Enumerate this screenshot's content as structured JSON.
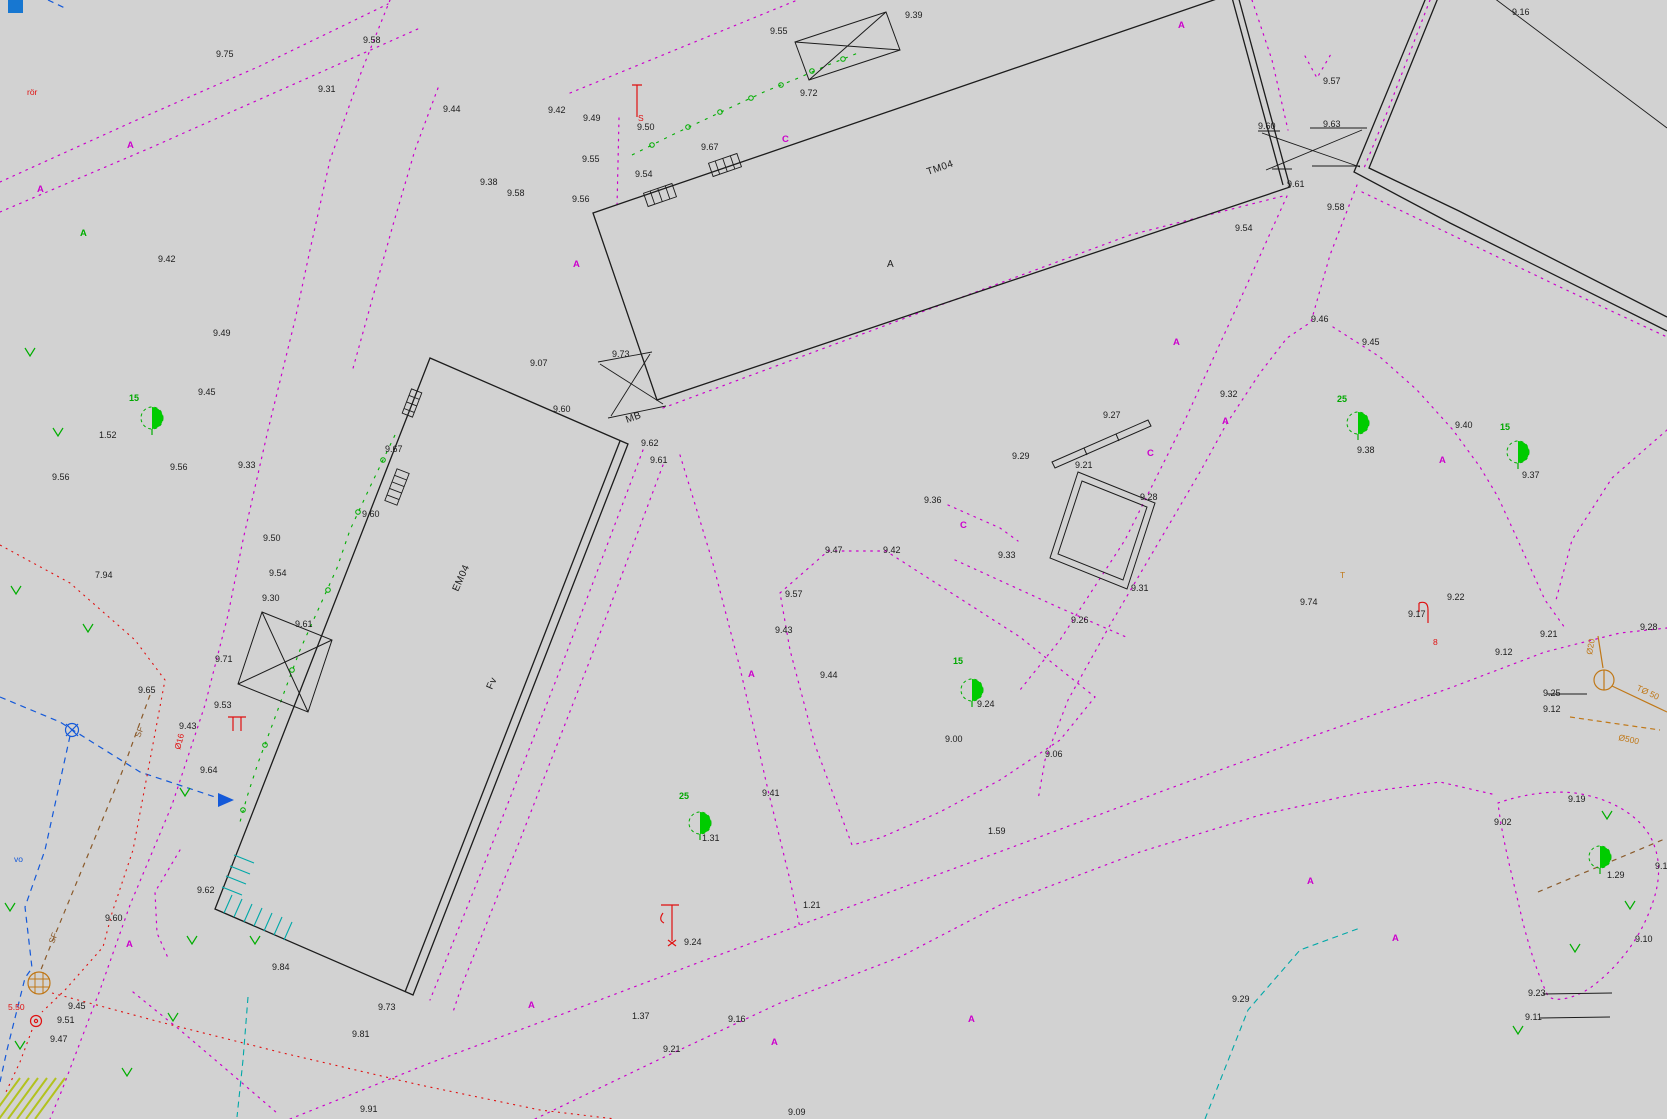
{
  "canvas": {
    "width": 1667,
    "height": 1119,
    "description": "topographic survey site plan"
  },
  "colors": {
    "background": "#d2d2d2",
    "line_black": "#1c1c1c",
    "boundary_magenta": "#cc00cc",
    "vegetation_green": "#00ae00",
    "tree_fill": "#00cc00",
    "water_blue": "#1459d9",
    "marker_blue": "#1777d1",
    "utility_red": "#e01010",
    "utility_cyan": "#00a8a8",
    "utility_brown": "#8a5a2a",
    "utility_orange": "#c07818",
    "hatch_yellow_green": "#b2c21e"
  },
  "building_labels": [
    {
      "t": "TM04",
      "x": 928,
      "y": 175,
      "rot": -19
    },
    {
      "t": "A",
      "x": 887,
      "y": 267,
      "rot": 0
    },
    {
      "t": "EM04",
      "x": 458,
      "y": 592,
      "rot": -66
    },
    {
      "t": "MB",
      "x": 627,
      "y": 423,
      "rot": -20
    },
    {
      "t": "Fv",
      "x": 492,
      "y": 690,
      "rot": -66
    }
  ],
  "spot_elevations": [
    {
      "t": "9.75",
      "x": 216,
      "y": 57
    },
    {
      "t": "9.31",
      "x": 318,
      "y": 92
    },
    {
      "t": "9.58",
      "x": 363,
      "y": 43
    },
    {
      "t": "9.44",
      "x": 443,
      "y": 112
    },
    {
      "t": "9.42",
      "x": 548,
      "y": 113
    },
    {
      "t": "9.38",
      "x": 480,
      "y": 185
    },
    {
      "t": "9.49",
      "x": 583,
      "y": 121
    },
    {
      "t": "9.50",
      "x": 637,
      "y": 130
    },
    {
      "t": "9.55",
      "x": 582,
      "y": 162
    },
    {
      "t": "9.58",
      "x": 507,
      "y": 196
    },
    {
      "t": "9.56",
      "x": 572,
      "y": 202
    },
    {
      "t": "9.54",
      "x": 635,
      "y": 177
    },
    {
      "t": "9.67",
      "x": 701,
      "y": 150
    },
    {
      "t": "9.55",
      "x": 770,
      "y": 34
    },
    {
      "t": "9.72",
      "x": 800,
      "y": 96
    },
    {
      "t": "9.39",
      "x": 905,
      "y": 18
    },
    {
      "t": "9.60",
      "x": 1258,
      "y": 129
    },
    {
      "t": "9.63",
      "x": 1323,
      "y": 127
    },
    {
      "t": "9.57",
      "x": 1323,
      "y": 84
    },
    {
      "t": "9.61",
      "x": 1287,
      "y": 187
    },
    {
      "t": "9.58",
      "x": 1327,
      "y": 210
    },
    {
      "t": "9.54",
      "x": 1235,
      "y": 231
    },
    {
      "t": "9.16",
      "x": 1512,
      "y": 15
    },
    {
      "t": "9.49",
      "x": 213,
      "y": 336
    },
    {
      "t": "9.45",
      "x": 198,
      "y": 395
    },
    {
      "t": "9.42",
      "x": 158,
      "y": 262
    },
    {
      "t": "1.52",
      "x": 99,
      "y": 438
    },
    {
      "t": "9.56",
      "x": 170,
      "y": 470
    },
    {
      "t": "9.33",
      "x": 238,
      "y": 468
    },
    {
      "t": "9.56",
      "x": 52,
      "y": 480
    },
    {
      "t": "7.94",
      "x": 95,
      "y": 578
    },
    {
      "t": "9.50",
      "x": 263,
      "y": 541
    },
    {
      "t": "9.54",
      "x": 269,
      "y": 576
    },
    {
      "t": "9.30",
      "x": 262,
      "y": 601
    },
    {
      "t": "9.71",
      "x": 215,
      "y": 662
    },
    {
      "t": "9.65",
      "x": 138,
      "y": 693
    },
    {
      "t": "9.53",
      "x": 214,
      "y": 708
    },
    {
      "t": "9.43",
      "x": 179,
      "y": 729
    },
    {
      "t": "9.64",
      "x": 200,
      "y": 773
    },
    {
      "t": "9.61",
      "x": 295,
      "y": 627
    },
    {
      "t": "9.60",
      "x": 362,
      "y": 517
    },
    {
      "t": "9.67",
      "x": 385,
      "y": 452
    },
    {
      "t": "9.07",
      "x": 530,
      "y": 366
    },
    {
      "t": "9.73",
      "x": 612,
      "y": 357
    },
    {
      "t": "9.60",
      "x": 553,
      "y": 412
    },
    {
      "t": "9.62",
      "x": 641,
      "y": 446
    },
    {
      "t": "9.61",
      "x": 650,
      "y": 463
    },
    {
      "t": "9.62",
      "x": 197,
      "y": 893
    },
    {
      "t": "9.60",
      "x": 105,
      "y": 921
    },
    {
      "t": "9.45",
      "x": 68,
      "y": 1009
    },
    {
      "t": "9.51",
      "x": 57,
      "y": 1023
    },
    {
      "t": "9.47",
      "x": 50,
      "y": 1042
    },
    {
      "t": "9.84",
      "x": 272,
      "y": 970
    },
    {
      "t": "9.73",
      "x": 378,
      "y": 1010
    },
    {
      "t": "9.81",
      "x": 352,
      "y": 1037
    },
    {
      "t": "9.91",
      "x": 360,
      "y": 1112
    },
    {
      "t": "1.37",
      "x": 632,
      "y": 1019
    },
    {
      "t": "9.21",
      "x": 663,
      "y": 1052
    },
    {
      "t": "9.16",
      "x": 728,
      "y": 1022
    },
    {
      "t": "9.09",
      "x": 788,
      "y": 1115
    },
    {
      "t": "1.21",
      "x": 803,
      "y": 908
    },
    {
      "t": "9.24",
      "x": 684,
      "y": 945
    },
    {
      "t": "1.31",
      "x": 702,
      "y": 841
    },
    {
      "t": "9.41",
      "x": 762,
      "y": 796
    },
    {
      "t": "9.47",
      "x": 825,
      "y": 553
    },
    {
      "t": "9.42",
      "x": 883,
      "y": 553
    },
    {
      "t": "9.57",
      "x": 785,
      "y": 597
    },
    {
      "t": "9.44",
      "x": 820,
      "y": 678
    },
    {
      "t": "9.43",
      "x": 775,
      "y": 633
    },
    {
      "t": "9.36",
      "x": 924,
      "y": 503
    },
    {
      "t": "9.33",
      "x": 998,
      "y": 558
    },
    {
      "t": "9.00",
      "x": 945,
      "y": 742
    },
    {
      "t": "9.06",
      "x": 1045,
      "y": 757
    },
    {
      "t": "1.59",
      "x": 988,
      "y": 834
    },
    {
      "t": "9.24",
      "x": 977,
      "y": 707
    },
    {
      "t": "9.29",
      "x": 1012,
      "y": 459
    },
    {
      "t": "9.27",
      "x": 1103,
      "y": 418
    },
    {
      "t": "9.21",
      "x": 1075,
      "y": 468
    },
    {
      "t": "9.28",
      "x": 1140,
      "y": 500
    },
    {
      "t": "9.31",
      "x": 1131,
      "y": 591
    },
    {
      "t": "9.26",
      "x": 1071,
      "y": 623
    },
    {
      "t": "9.46",
      "x": 1311,
      "y": 322
    },
    {
      "t": "9.45",
      "x": 1362,
      "y": 345
    },
    {
      "t": "9.38",
      "x": 1357,
      "y": 453
    },
    {
      "t": "9.40",
      "x": 1455,
      "y": 428
    },
    {
      "t": "9.32",
      "x": 1220,
      "y": 397
    },
    {
      "t": "9.74",
      "x": 1300,
      "y": 605
    },
    {
      "t": "9.22",
      "x": 1447,
      "y": 600
    },
    {
      "t": "9.17",
      "x": 1408,
      "y": 617
    },
    {
      "t": "9.21",
      "x": 1540,
      "y": 637
    },
    {
      "t": "9.12",
      "x": 1495,
      "y": 655
    },
    {
      "t": "9.28",
      "x": 1640,
      "y": 630
    },
    {
      "t": "9.25",
      "x": 1543,
      "y": 696
    },
    {
      "t": "9.12",
      "x": 1543,
      "y": 712
    },
    {
      "t": "9.19",
      "x": 1568,
      "y": 802
    },
    {
      "t": "9.02",
      "x": 1494,
      "y": 825
    },
    {
      "t": "9.15",
      "x": 1655,
      "y": 869
    },
    {
      "t": "9.10",
      "x": 1635,
      "y": 942
    },
    {
      "t": "1.29",
      "x": 1607,
      "y": 878
    },
    {
      "t": "9.37",
      "x": 1522,
      "y": 478
    },
    {
      "t": "9.29",
      "x": 1232,
      "y": 1002
    },
    {
      "t": "9.23",
      "x": 1528,
      "y": 996
    },
    {
      "t": "9.11",
      "x": 1525,
      "y": 1020
    }
  ],
  "tree_counts": [
    {
      "t": "15",
      "x": 129,
      "y": 401
    },
    {
      "t": "25",
      "x": 679,
      "y": 799
    },
    {
      "t": "15",
      "x": 953,
      "y": 664
    },
    {
      "t": "25",
      "x": 1337,
      "y": 402
    },
    {
      "t": "15",
      "x": 1500,
      "y": 430
    }
  ],
  "area_letters": [
    {
      "t": "A",
      "x": 1178,
      "y": 28,
      "c": "magenta"
    },
    {
      "t": "A",
      "x": 127,
      "y": 148,
      "c": "magenta"
    },
    {
      "t": "A",
      "x": 37,
      "y": 192,
      "c": "magenta"
    },
    {
      "t": "A",
      "x": 573,
      "y": 267,
      "c": "magenta"
    },
    {
      "t": "A",
      "x": 80,
      "y": 236,
      "c": "green"
    },
    {
      "t": "A",
      "x": 126,
      "y": 947,
      "c": "magenta"
    },
    {
      "t": "A",
      "x": 528,
      "y": 1008,
      "c": "magenta"
    },
    {
      "t": "A",
      "x": 771,
      "y": 1045,
      "c": "magenta"
    },
    {
      "t": "A",
      "x": 968,
      "y": 1022,
      "c": "magenta"
    },
    {
      "t": "A",
      "x": 748,
      "y": 677,
      "c": "magenta"
    },
    {
      "t": "A",
      "x": 1173,
      "y": 345,
      "c": "magenta"
    },
    {
      "t": "A",
      "x": 1222,
      "y": 424,
      "c": "magenta"
    },
    {
      "t": "A",
      "x": 1439,
      "y": 463,
      "c": "magenta"
    },
    {
      "t": "A",
      "x": 1392,
      "y": 941,
      "c": "magenta"
    },
    {
      "t": "A",
      "x": 1307,
      "y": 884,
      "c": "magenta"
    },
    {
      "t": "C",
      "x": 782,
      "y": 142,
      "c": "magenta"
    },
    {
      "t": "C",
      "x": 960,
      "y": 528,
      "c": "magenta"
    },
    {
      "t": "C",
      "x": 1147,
      "y": 456,
      "c": "magenta"
    }
  ],
  "utility_labels": [
    {
      "t": "S",
      "x": 638,
      "y": 121,
      "c": "red",
      "rot": 0
    },
    {
      "t": "8",
      "x": 1433,
      "y": 645,
      "c": "red",
      "rot": 0
    },
    {
      "t": "5.50",
      "x": 8,
      "y": 1010,
      "c": "red",
      "rot": 0
    },
    {
      "t": "Ø16",
      "x": 180,
      "y": 750,
      "c": "red",
      "rot": -75
    },
    {
      "t": "rör",
      "x": 27,
      "y": 95,
      "c": "red",
      "rot": 0
    },
    {
      "t": "SF",
      "x": 54,
      "y": 944,
      "c": "brown",
      "rot": -70
    },
    {
      "t": "SF",
      "x": 140,
      "y": 738,
      "c": "brown",
      "rot": -70
    },
    {
      "t": "Ø20",
      "x": 1592,
      "y": 655,
      "c": "orange",
      "rot": -80
    },
    {
      "t": "TØ 50",
      "x": 1636,
      "y": 690,
      "c": "orange",
      "rot": 25
    },
    {
      "t": "Ø500",
      "x": 1618,
      "y": 740,
      "c": "orange",
      "rot": 12
    },
    {
      "t": "T",
      "x": 1340,
      "y": 578,
      "c": "orange",
      "rot": 0
    },
    {
      "t": "vo",
      "x": 14,
      "y": 862,
      "c": "blue",
      "rot": 0
    }
  ],
  "trees": [
    {
      "x": 152,
      "y": 418
    },
    {
      "x": 700,
      "y": 823
    },
    {
      "x": 972,
      "y": 690
    },
    {
      "x": 1358,
      "y": 423
    },
    {
      "x": 1518,
      "y": 452
    },
    {
      "x": 1600,
      "y": 857
    }
  ],
  "grass_marks": [
    [
      30,
      352
    ],
    [
      58,
      432
    ],
    [
      16,
      590
    ],
    [
      88,
      628
    ],
    [
      185,
      792
    ],
    [
      10,
      907
    ],
    [
      192,
      940
    ],
    [
      255,
      940
    ],
    [
      173,
      1017
    ],
    [
      127,
      1072
    ],
    [
      20,
      1045
    ],
    [
      1607,
      815
    ],
    [
      1630,
      905
    ],
    [
      1575,
      948
    ],
    [
      1518,
      1030
    ]
  ]
}
